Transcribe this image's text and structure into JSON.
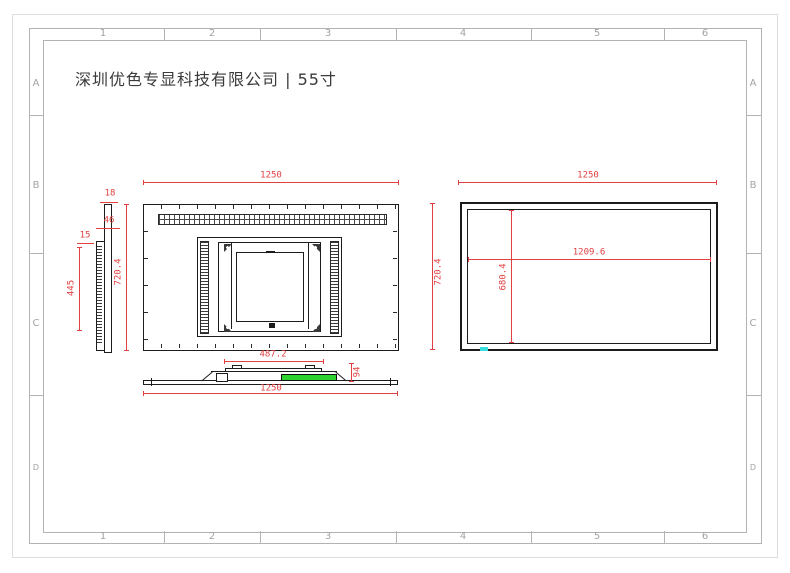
{
  "title": "深圳优色专显科技有限公司 | 55寸",
  "grid": {
    "cols": [
      "1",
      "2",
      "3",
      "4",
      "5",
      "6"
    ],
    "rows": [
      "A",
      "B",
      "C",
      "D"
    ]
  },
  "dims": {
    "side_front_thickness": "18",
    "side_body_thickness": "46",
    "side_mount_thickness": "15",
    "side_vent_height": "445",
    "side_height": "720.4",
    "rear_width": "1250",
    "vesa_width": "487.2",
    "bottom_width": "1250",
    "bottom_depth": "94",
    "front_width": "1250",
    "front_height": "720.4",
    "active_width": "1209.6",
    "active_height": "680.4"
  },
  "colors": {
    "dimension_red": "#e04040",
    "outline_black": "#1c1c1c",
    "frame_gray": "#b3b3b3",
    "connector_green": "#2fd32f",
    "touch_cyan": "#38dede"
  }
}
